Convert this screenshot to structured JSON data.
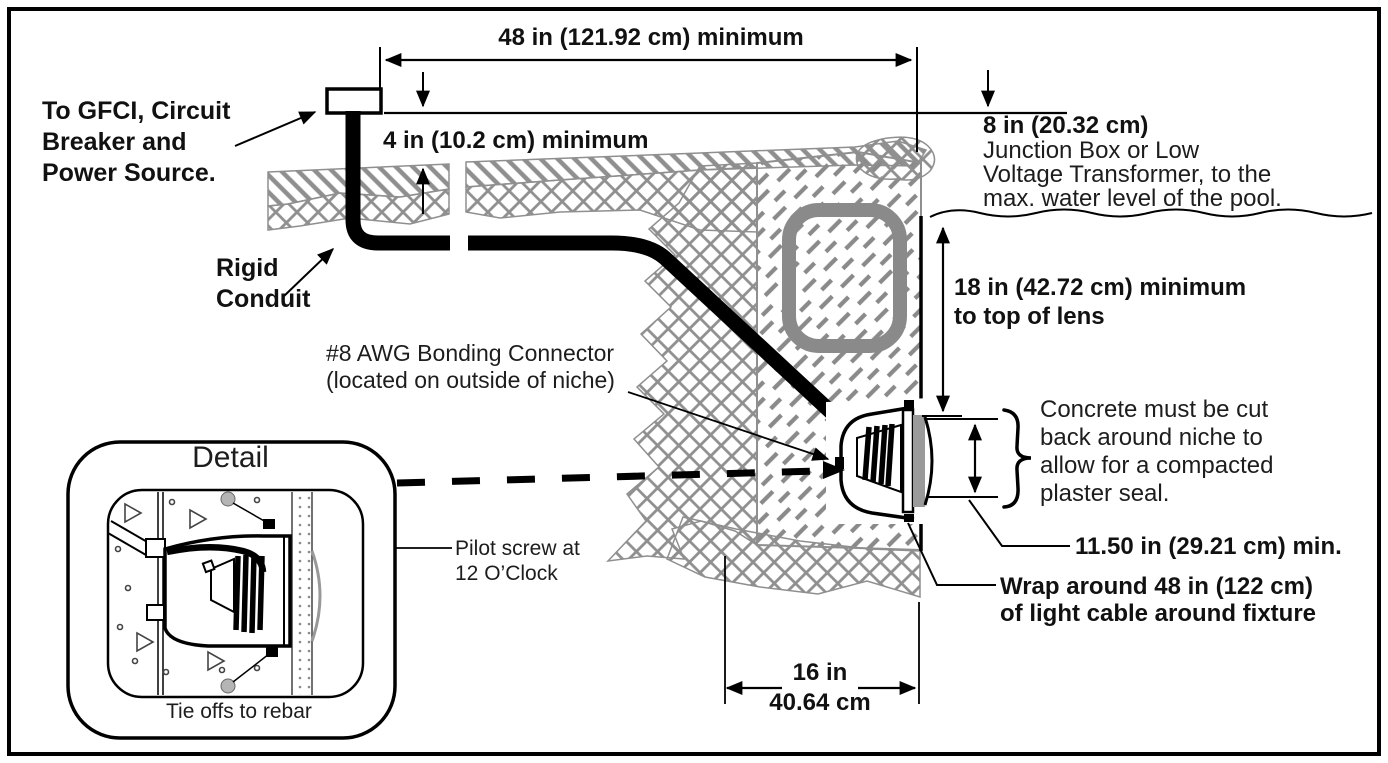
{
  "diagram": {
    "description": "Pool light niche installation cross-section diagram",
    "labels": {
      "gfci": "To GFCI, Circuit\nBreaker and\nPower Source.",
      "dim48": "48 in (121.92 cm) minimum",
      "dim4": "4 in (10.2 cm) minimum",
      "rigid_conduit": "Rigid\nConduit",
      "dim8_value": "8 in (20.32 cm)",
      "dim8_desc": "Junction Box or Low\nVoltage Transformer, to the\nmax. water level of the pool.",
      "dim18": "18 in (42.72 cm) minimum\nto top of lens",
      "bonding": "#8 AWG Bonding Connector\n(located on outside of niche)",
      "concrete_note": "Concrete must be cut\nback around niche to\nallow for a compacted\nplaster seal.",
      "dim1150": "11.50 in (29.21 cm) min.",
      "wrap_note": "Wrap around 48 in (122 cm)\nof light cable around fixture",
      "dim16_in": "16 in",
      "dim16_cm": "40.64 cm",
      "detail_title": "Detail",
      "pilot_screw": "Pilot screw at\n12 O’Clock",
      "tie_offs": "Tie offs to rebar"
    },
    "colors": {
      "line": "#000000",
      "hatch_gray": "#8f8f8f",
      "ring_gray": "#8a8a8a",
      "lens_gray": "#9a9a9a",
      "rebar_gray": "#b5b5b5",
      "background": "#ffffff"
    }
  }
}
